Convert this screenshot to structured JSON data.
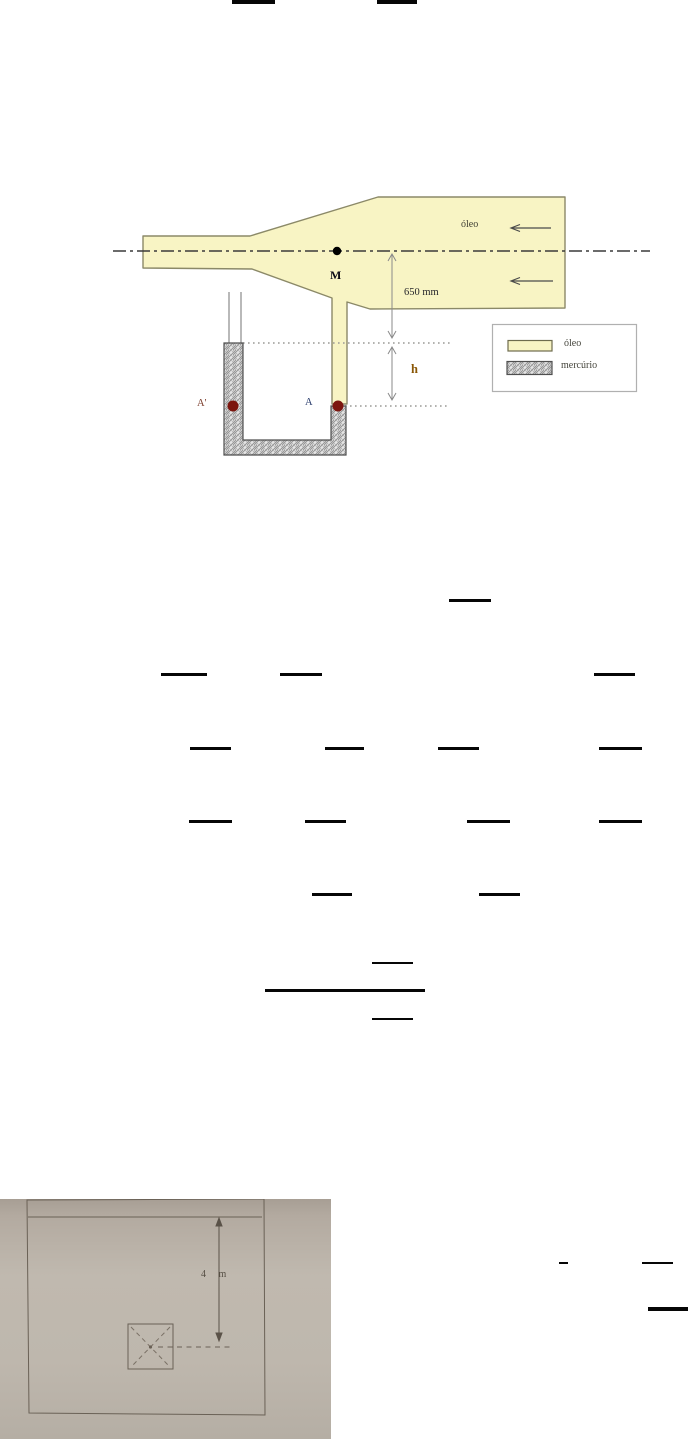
{
  "figure1": {
    "labels": {
      "oil_flow": "óleo",
      "point_m": "M",
      "dim_650": "650 mm",
      "dim_h": "h",
      "point_a_prime": "A'",
      "point_a": "A"
    },
    "legend": {
      "oil": "óleo",
      "mercury": "mercúrio"
    },
    "colors": {
      "oil_fill": "#f8f4c4",
      "oil_border": "#8b8968",
      "mercury_bg": "#e4e4e4",
      "mercury_hatch": "#8a8a8a",
      "tap_dot": "#7c150e"
    }
  },
  "figure2": {
    "dim_label": "4 m"
  },
  "formula_bars": [
    {
      "x": 232,
      "y": 0,
      "w": 43,
      "h": 4
    },
    {
      "x": 377,
      "y": 0,
      "w": 40,
      "h": 4
    },
    {
      "x": 449,
      "y": 599,
      "w": 42,
      "h": 3
    },
    {
      "x": 161,
      "y": 673,
      "w": 46,
      "h": 3
    },
    {
      "x": 280,
      "y": 673,
      "w": 42,
      "h": 3
    },
    {
      "x": 594,
      "y": 673,
      "w": 41,
      "h": 3
    },
    {
      "x": 190,
      "y": 747,
      "w": 41,
      "h": 3
    },
    {
      "x": 325,
      "y": 747,
      "w": 39,
      "h": 3
    },
    {
      "x": 438,
      "y": 747,
      "w": 41,
      "h": 3
    },
    {
      "x": 599,
      "y": 747,
      "w": 43,
      "h": 3
    },
    {
      "x": 189,
      "y": 820,
      "w": 43,
      "h": 3
    },
    {
      "x": 305,
      "y": 820,
      "w": 41,
      "h": 3
    },
    {
      "x": 467,
      "y": 820,
      "w": 43,
      "h": 3
    },
    {
      "x": 599,
      "y": 820,
      "w": 43,
      "h": 3
    },
    {
      "x": 312,
      "y": 893,
      "w": 40,
      "h": 3
    },
    {
      "x": 479,
      "y": 893,
      "w": 41,
      "h": 3
    },
    {
      "x": 372,
      "y": 962,
      "w": 41,
      "h": 2
    },
    {
      "x": 265,
      "y": 989,
      "w": 160,
      "h": 3
    },
    {
      "x": 372,
      "y": 1018,
      "w": 41,
      "h": 2
    },
    {
      "x": 559,
      "y": 1262,
      "w": 9,
      "h": 2
    },
    {
      "x": 642,
      "y": 1262,
      "w": 31,
      "h": 2
    },
    {
      "x": 648,
      "y": 1307,
      "w": 40,
      "h": 4
    }
  ]
}
